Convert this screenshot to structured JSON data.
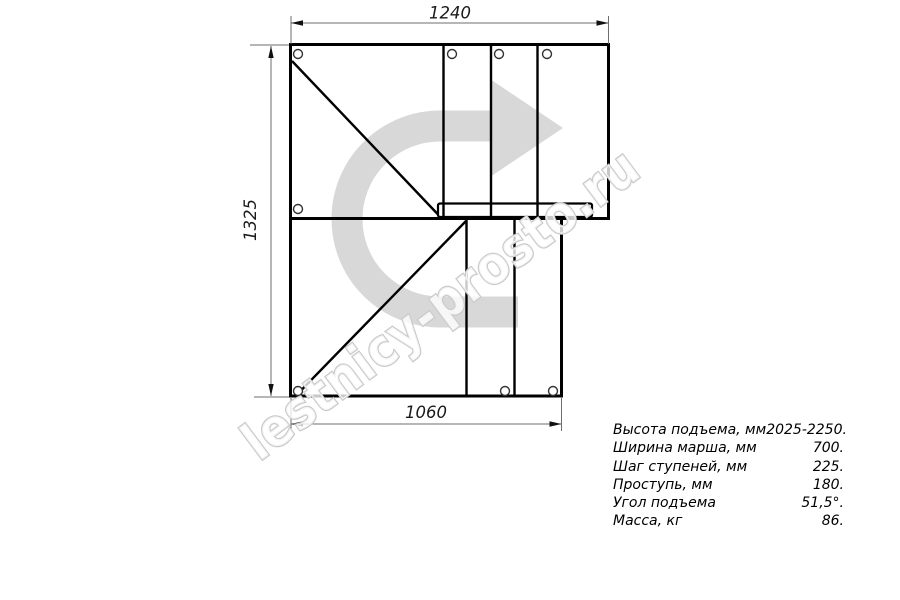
{
  "drawing": {
    "title": "staircase-plan-view",
    "dim_top": "1240",
    "dim_left": "1325",
    "dim_bottom": "1060"
  },
  "watermark": {
    "text": "lestnicy-prosto.ru"
  },
  "specs": {
    "rows": [
      {
        "label": "Высота подъема, мм",
        "value": "2025-2250."
      },
      {
        "label": "Ширина марша, мм",
        "value": "700."
      },
      {
        "label": "Шаг ступеней, мм",
        "value": "225."
      },
      {
        "label": "Проступь, мм",
        "value": "180."
      },
      {
        "label": "Угол подъема",
        "value": "51,5°."
      },
      {
        "label": "Масса, кг",
        "value": "86."
      }
    ]
  },
  "colors": {
    "line": "#000000",
    "dimension_line": "#6e6e6e",
    "watermark_arrow": "#d8d8d8",
    "watermark_outline": "#c9c9c9"
  }
}
